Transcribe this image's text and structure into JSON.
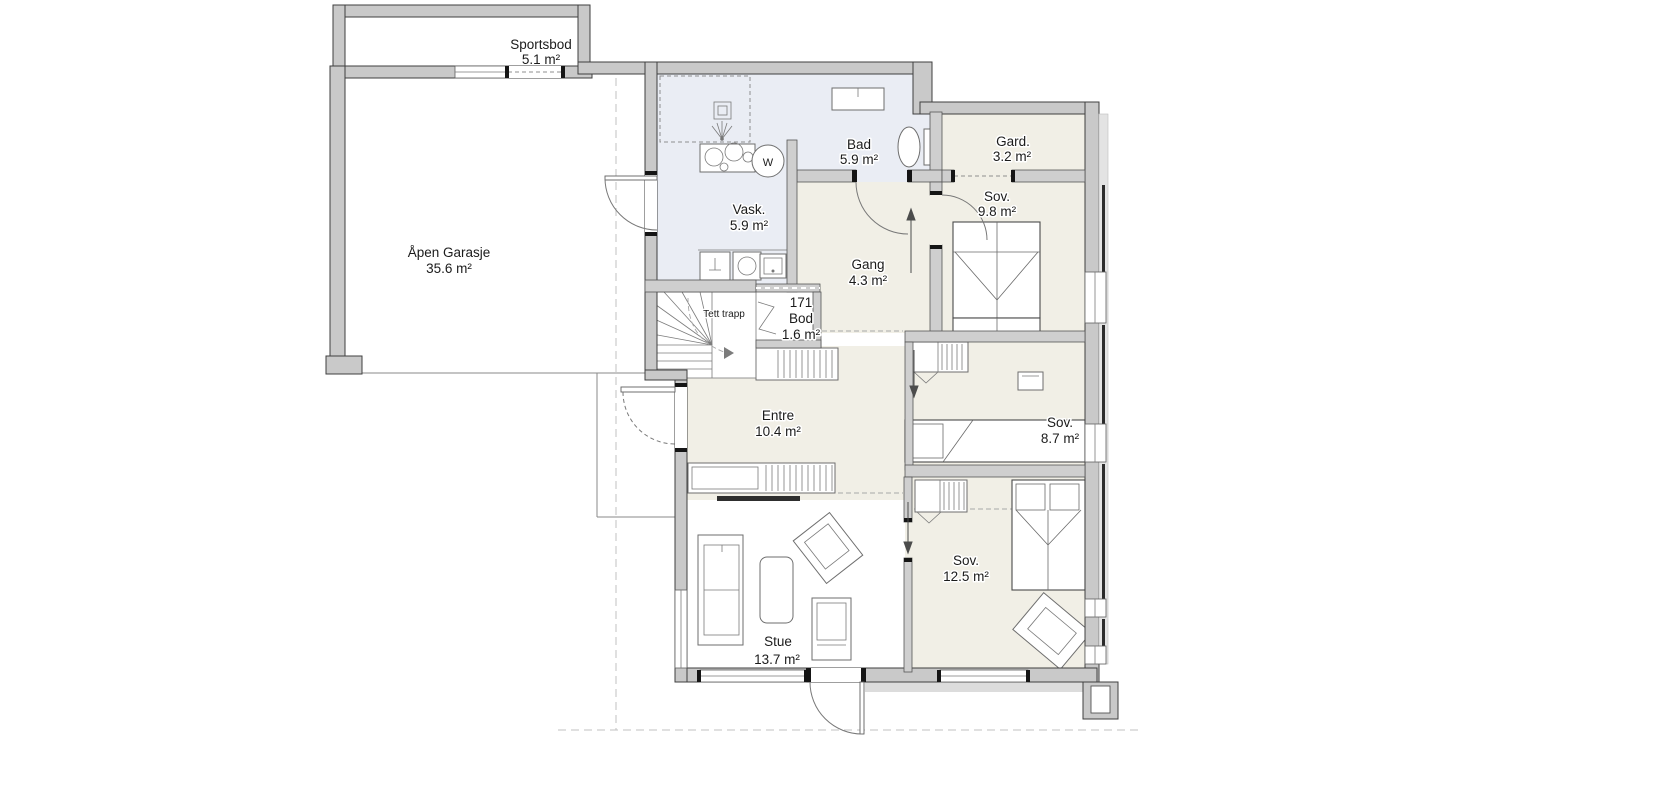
{
  "rooms": {
    "sportsbod": {
      "name": "Sportsbod",
      "area": "5.1 m²"
    },
    "garasje": {
      "name": "Åpen Garasje",
      "area": "35.6 m²"
    },
    "bad": {
      "name": "Bad",
      "area": "5.9 m²"
    },
    "vask": {
      "name": "Vask.",
      "area": "5.9 m²"
    },
    "gard": {
      "name": "Gard.",
      "area": "3.2 m²"
    },
    "sov_9_8": {
      "name": "Sov.",
      "area": "9.8 m²"
    },
    "gang": {
      "name": "Gang",
      "area": "4.3 m²"
    },
    "bod": {
      "number": "171",
      "name": "Bod",
      "area": "1.6 m²"
    },
    "trapp": {
      "name": "Tett trapp"
    },
    "entre": {
      "name": "Entre",
      "area": "10.4 m²"
    },
    "sov_8_7": {
      "name": "Sov.",
      "area": "8.7 m²"
    },
    "sov_12_5": {
      "name": "Sov.",
      "area": "12.5 m²"
    },
    "stue": {
      "name": "Stue",
      "area": "13.7 m²"
    }
  },
  "fixtures": {
    "washing_machine_label": "W"
  },
  "colors": {
    "wet_room_floor": "#eaedf4",
    "room_floor": "#f1efe6",
    "wall_fill": "#c9c9c9"
  }
}
